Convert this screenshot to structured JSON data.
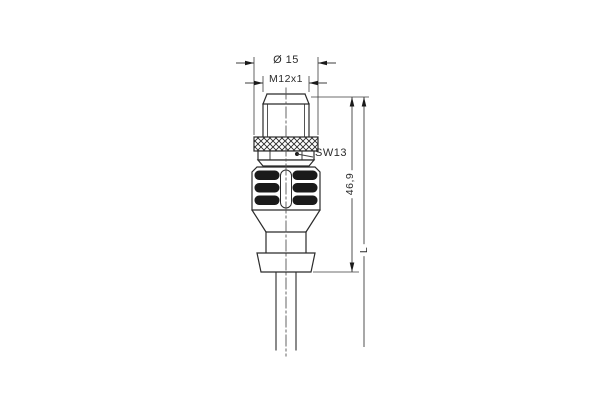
{
  "page": {
    "background": "#ffffff",
    "line_color": "#2b2b2b",
    "dim_color": "#3d3d3d"
  },
  "drawing": {
    "labels": {
      "diameter": "Ø 15",
      "thread": "M12x1",
      "wrench_size": "SW13",
      "length_body": "46,9",
      "length_cable": "L"
    }
  }
}
